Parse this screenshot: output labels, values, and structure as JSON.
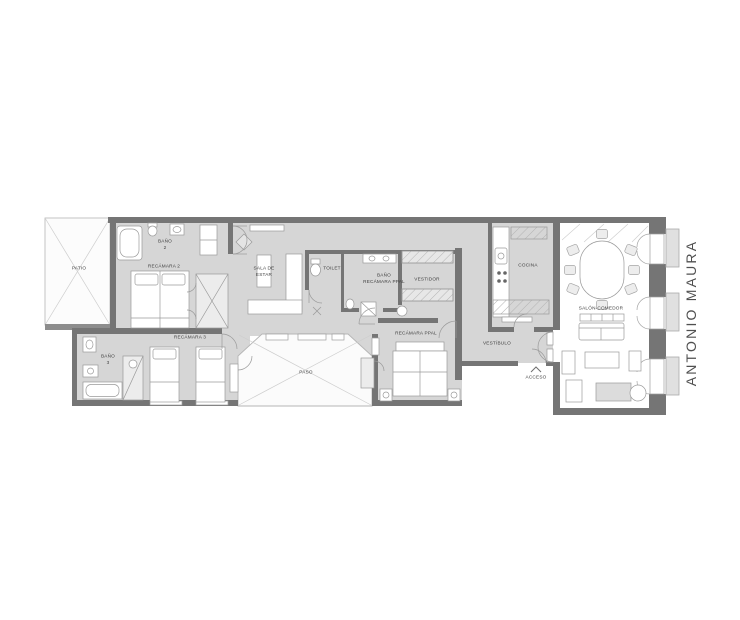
{
  "plan": {
    "rooms": {
      "patio": {
        "label": "PATIO"
      },
      "bano2": {
        "label": "BAÑO\n2"
      },
      "recamara2": {
        "label": "RECÁMARA 2"
      },
      "sala_estar": {
        "label": "SALA DE\nESTAR"
      },
      "toilet": {
        "label": "TOILET"
      },
      "bano_ppal": {
        "label": "BAÑO\nRECÁMARA PPAL"
      },
      "vestidor": {
        "label": "VESTIDOR"
      },
      "cocina": {
        "label": "COCINA"
      },
      "bano3": {
        "label": "BAÑO\n3"
      },
      "recamara3": {
        "label": "RECÁMARA 3"
      },
      "paso": {
        "label": "PASO"
      },
      "recamara_ppal": {
        "label": "RECÁMARA PPAL"
      },
      "vestibulo": {
        "label": "VESTÍBULO"
      },
      "acceso": {
        "label": "ACCESO"
      },
      "salon_comedor": {
        "label": "SALÓN-COMEDOR"
      }
    },
    "street": {
      "label": "ANTONIO MAURA"
    },
    "colors": {
      "wall": "#757575",
      "floor": "#d6d6d6",
      "outdoor": "#fbfbfb",
      "balcony": "#e0e0e0",
      "furniture_stroke": "#9a9a9a",
      "label_text": "#3e3e3e",
      "street_text": "#4f4f4f"
    }
  }
}
